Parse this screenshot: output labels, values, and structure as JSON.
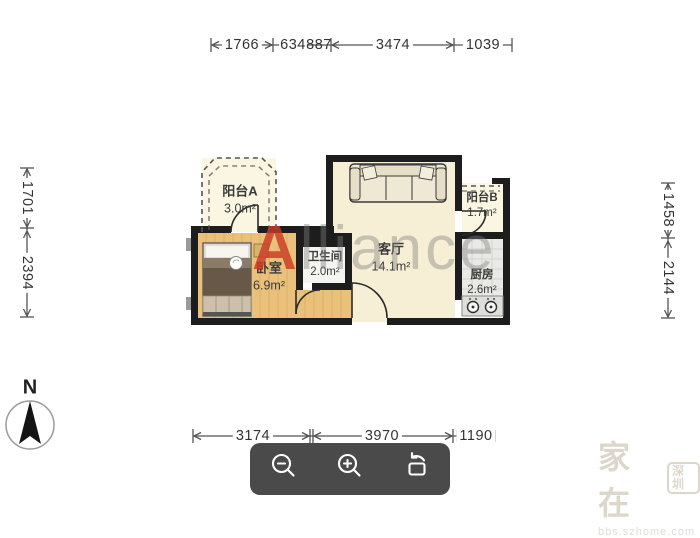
{
  "plan_title": "floorplan",
  "rooms": {
    "balcony_a": {
      "name": "阳台A",
      "area": "3.0m²"
    },
    "bedroom": {
      "name": "卧室",
      "area": "6.9m²"
    },
    "bathroom": {
      "name": "卫生间",
      "area": "2.0m²"
    },
    "living": {
      "name": "客厅",
      "area": "14.1m²"
    },
    "balcony_b": {
      "name": "阳台B",
      "area": "1.7m²"
    },
    "kitchen": {
      "name": "厨房",
      "area": "2.6m²"
    }
  },
  "dimensions": {
    "top": [
      "1766",
      "634",
      "887",
      "3474",
      "1039"
    ],
    "bottom": [
      "3174",
      "3970",
      "1190"
    ],
    "left": [
      "1701",
      "2394"
    ],
    "right": [
      "1458",
      "2144"
    ]
  },
  "compass": {
    "label": "N"
  },
  "watermark_center": {
    "first": "A",
    "rest": "lliance"
  },
  "watermark_corner": {
    "big": "家在",
    "badge": "深圳",
    "url": "bbs.szhome.com"
  },
  "toolbar": {
    "button_icons": [
      "zoom-out",
      "zoom-in",
      "rotate-screen"
    ]
  },
  "colors": {
    "wall": "#1d1d1d",
    "floor_cream": "#f7efd5",
    "floor_balcony": "#faf6e2",
    "floor_wood": "#eac17b",
    "floor_bath": "#f4f4f1",
    "floor_kitchen": "#e9e9e6",
    "dimension_text": "#333333",
    "watermark_red": "#cb3a24",
    "toolbar_bg": "#4a4a4a"
  }
}
